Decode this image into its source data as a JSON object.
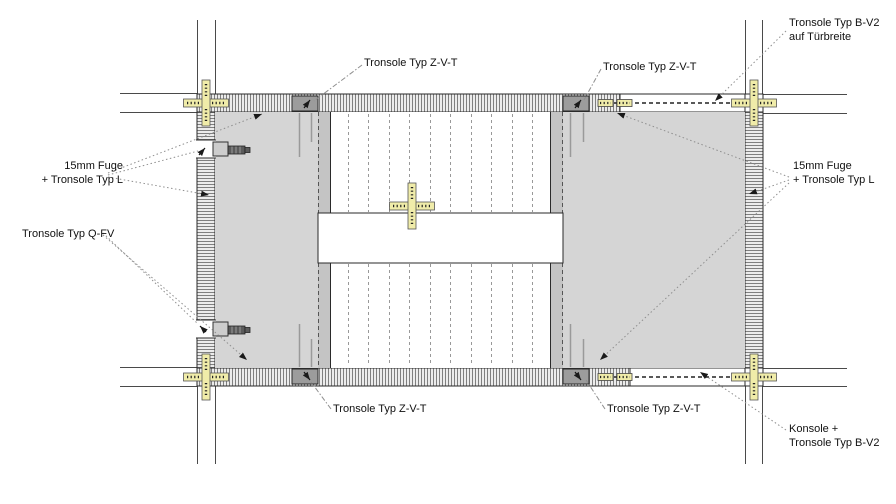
{
  "labels": {
    "zvt_top_left": "Tronsole Typ Z-V-T",
    "zvt_top_right": "Tronsole Typ Z-V-T",
    "zvt_bottom_left": "Tronsole Typ Z-V-T",
    "zvt_bottom_right": "Tronsole Typ Z-V-T",
    "bv2_door_line1": "Tronsole Typ B-V2",
    "bv2_door_line2": "auf Türbreite",
    "fuge_left_line1": "15mm Fuge",
    "fuge_left_line2": "+ Tronsole Typ L",
    "qfv": "Tronsole Typ Q-FV",
    "fuge_right_line1": "15mm Fuge",
    "fuge_right_line2": "+ Tronsole Typ L",
    "konsole_line1": "Konsole +",
    "konsole_line2": "Tronsole Typ B-V2"
  },
  "colors": {
    "landing_gray": "#d5d5d5",
    "flight_strip_gray": "#c4c4c4",
    "marker_yellow": "#f0eca9",
    "tronsole_block_gray": "#9c9c9c",
    "leader_gray": "#8f8f8f",
    "line_dark": "#2a2a2a"
  }
}
